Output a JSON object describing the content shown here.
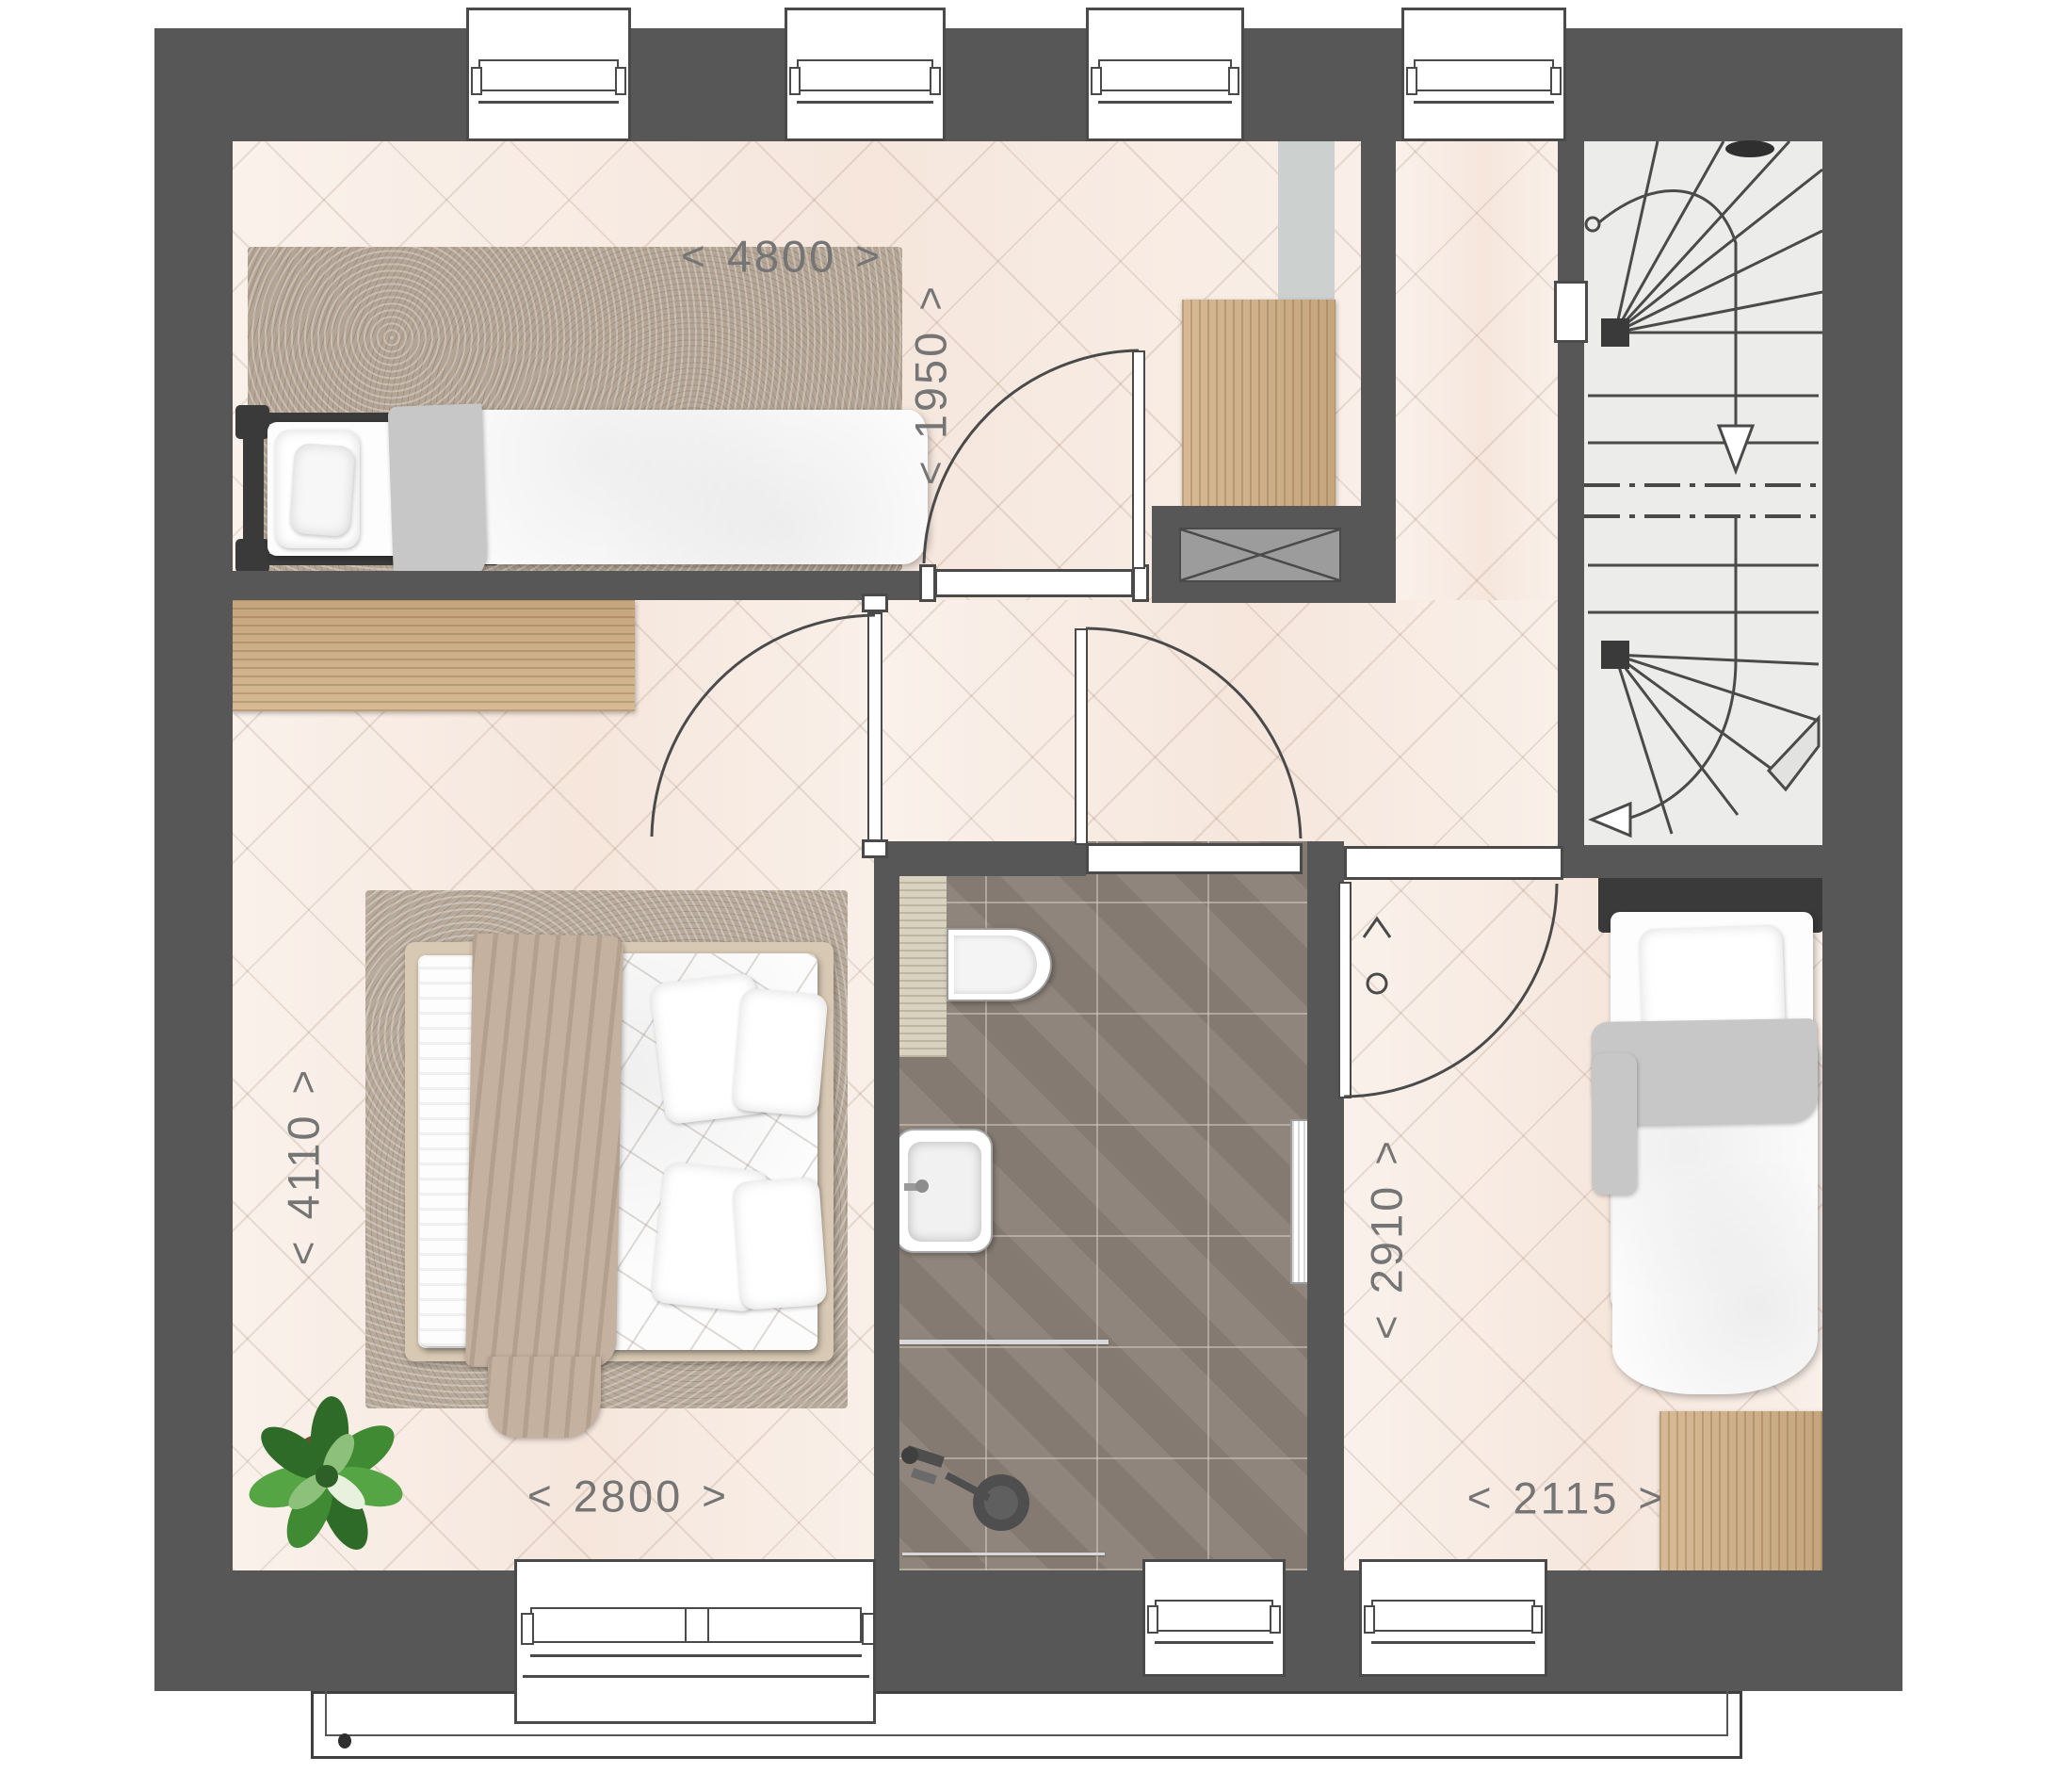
{
  "title": "first-floor plan with three bedrooms, bathroom and winder staircase",
  "dim_arrows": {
    "left": "<",
    "right": ">"
  },
  "dimensions": {
    "d4800": {
      "value": "4800",
      "orientation": "horizontal",
      "room": "bedroom-top"
    },
    "d1950": {
      "value": "1950",
      "orientation": "vertical",
      "room": "bedroom-top"
    },
    "d4110": {
      "value": "4110",
      "orientation": "vertical",
      "room": "bedroom-master"
    },
    "d2800": {
      "value": "2800",
      "orientation": "horizontal",
      "room": "bedroom-master"
    },
    "d2910": {
      "value": "2910",
      "orientation": "vertical",
      "room": "bedroom-right"
    },
    "d2115": {
      "value": "2115",
      "orientation": "horizontal",
      "room": "bedroom-right"
    }
  },
  "colors": {
    "wall": "#575757",
    "outline": "#4a4a4a",
    "floor_base": "#f8ece3",
    "floor_line": "#c9b2a2",
    "bath_tile": "#8b8177",
    "bath_grout": "#b9afa4",
    "rug": "#b3a494",
    "wood": "#cfae83",
    "stair_tread": "#ececea",
    "appliance_gray": "#ccd1d0",
    "vent_box_gray": "#9c9c9c",
    "dim_text": "#757575",
    "plant_green": "#3f8a33",
    "blanket_gray": "#c7c7c7"
  },
  "icons": [
    "window-icon",
    "door-icon",
    "door-swing-arc-icon",
    "stairs-winder-icon",
    "stair-direction-arrow-icon",
    "section-break-icon",
    "ceiling-light-icon",
    "toilet-icon",
    "sink-icon",
    "shower-head-icon",
    "towel-radiator-icon",
    "vent-shaft-icon",
    "single-bed-icon",
    "double-bed-icon",
    "wardrobe-icon",
    "desk-icon",
    "rug-icon",
    "plant-icon",
    "balcony-icon",
    "switch-icon"
  ]
}
